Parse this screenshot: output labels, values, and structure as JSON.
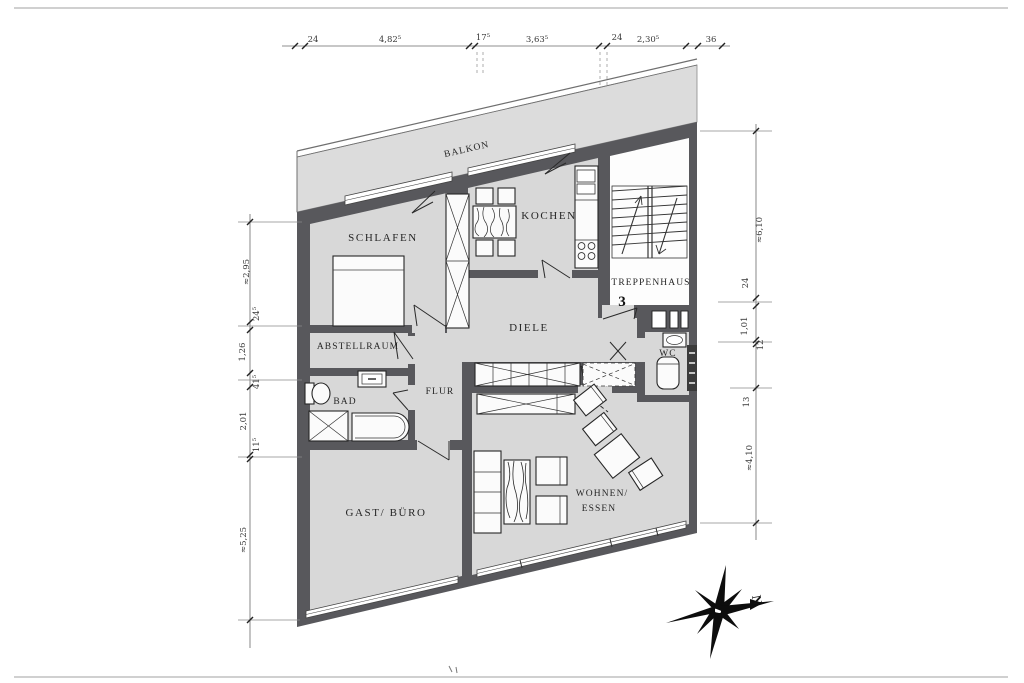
{
  "drawing": {
    "type": "apartment floor plan (scanned architectural drawing)",
    "unit_number": "3"
  },
  "rooms": {
    "balkon": "BALKON",
    "schlafen": "SCHLAFEN",
    "kochen": "KOCHEN",
    "treppenhaus": "TREPPENHAUS",
    "treppenhaus_no": "3",
    "diele": "DIELE",
    "wc": "WC",
    "abstellraum": "ABSTELLRAUM",
    "bad": "BAD",
    "flur": "FLUR",
    "gast_buero": "GAST/ BÜRO",
    "wohnen_line1": "WOHNEN/",
    "wohnen_line2": "ESSEN"
  },
  "compass": {
    "north": "N"
  },
  "dims": {
    "top": [
      "24",
      "4,82⁵",
      "17⁵",
      "3,63⁵",
      "24",
      "2,30⁵",
      "36"
    ],
    "left": [
      "≈2,95",
      "24⁵",
      "1,26",
      "41⁵",
      "2,01",
      "11⁵",
      "≈5,25"
    ],
    "right": [
      "≈6,10",
      "24",
      "1,01",
      "12",
      "13",
      "≈4,10"
    ]
  },
  "colors": {
    "wall": "#58585c",
    "floor": "#d8d8d8",
    "balcony_floor": "#dcdcdc",
    "paper": "#ffffff",
    "ink": "#262626"
  }
}
